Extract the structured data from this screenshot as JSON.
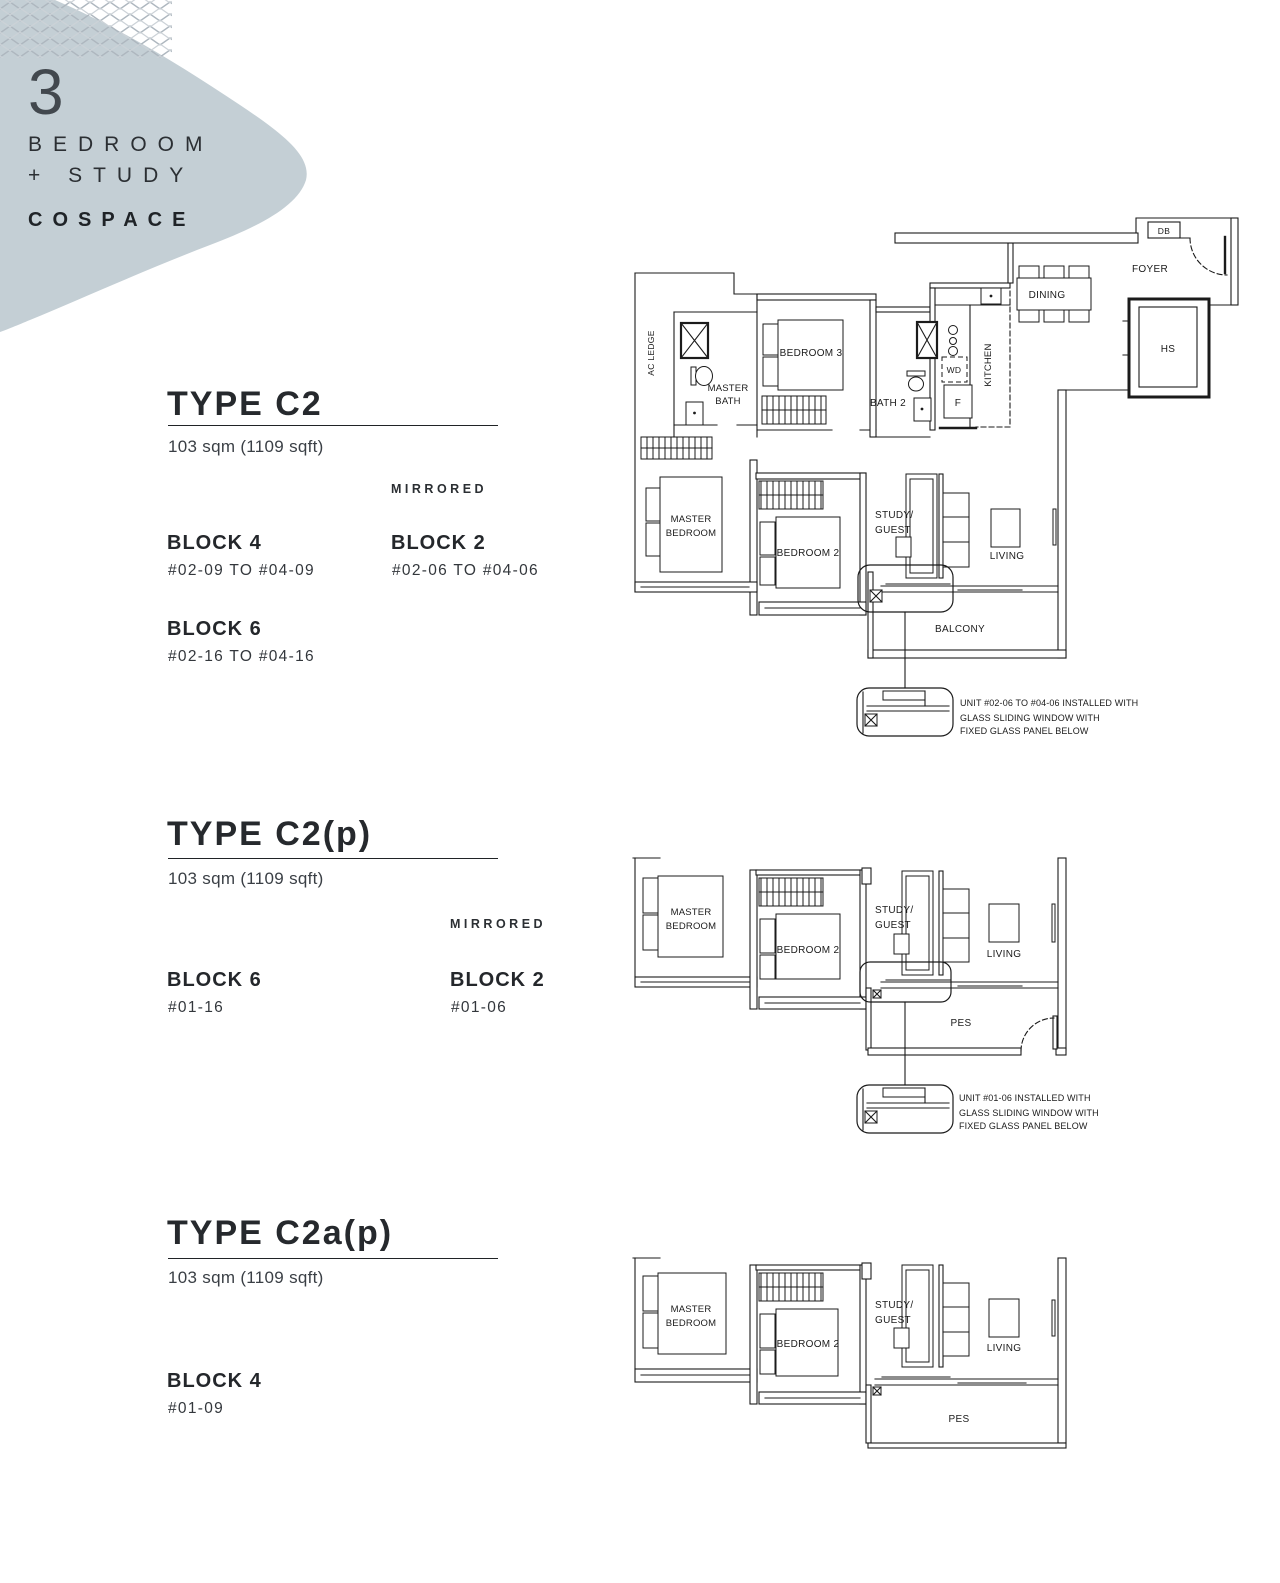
{
  "header": {
    "unit_number": "3",
    "unit_line1": "BEDROOM",
    "unit_line2": "+ STUDY",
    "brand": "COSPACE"
  },
  "sections": [
    {
      "title": "TYPE C2",
      "area": "103 sqm (1109 sqft)",
      "mirrored": "MIRRORED",
      "columns": {
        "col1": [
          {
            "block": "BLOCK 4",
            "units": "#02-09 TO #04-09"
          },
          {
            "block": "BLOCK 6",
            "units": "#02-16 TO #04-16"
          }
        ],
        "col2": [
          {
            "block": "BLOCK 2",
            "units": "#02-06 TO #04-06"
          }
        ]
      },
      "note": [
        "UNIT #02-06 TO #04-06 INSTALLED WITH",
        "GLASS SLIDING WINDOW WITH",
        "FIXED GLASS PANEL BELOW"
      ]
    },
    {
      "title": "TYPE C2(p)",
      "area": "103 sqm (1109 sqft)",
      "mirrored": "MIRRORED",
      "columns": {
        "col1": [
          {
            "block": "BLOCK 6",
            "units": "#01-16"
          }
        ],
        "col2": [
          {
            "block": "BLOCK 2",
            "units": "#01-06"
          }
        ]
      },
      "note": [
        "UNIT #01-06 INSTALLED WITH",
        "GLASS SLIDING WINDOW WITH",
        "FIXED GLASS PANEL BELOW"
      ]
    },
    {
      "title": "TYPE C2a(p)",
      "area": "103 sqm (1109 sqft)",
      "columns": {
        "col1": [
          {
            "block": "BLOCK 4",
            "units": "#01-09"
          }
        ]
      }
    }
  ],
  "plan_labels": {
    "c2": {
      "ac_ledge": "AC LEDGE",
      "master_bath1": "MASTER",
      "master_bath2": "BATH",
      "bedroom3": "BEDROOM 3",
      "bath2": "BATH 2",
      "wd": "WD",
      "fridge": "F",
      "kitchen": "KITCHEN",
      "dining": "DINING",
      "db": "DB",
      "foyer": "FOYER",
      "hs": "HS",
      "master_bed1": "MASTER",
      "master_bed2": "BEDROOM",
      "bedroom2": "BEDROOM 2",
      "study1": "STUDY/",
      "study2": "GUEST",
      "living": "LIVING",
      "balcony": "BALCONY"
    },
    "c2p": {
      "master_bed1": "MASTER",
      "master_bed2": "BEDROOM",
      "bedroom2": "BEDROOM 2",
      "study1": "STUDY/",
      "study2": "GUEST",
      "living": "LIVING",
      "pes": "PES"
    },
    "c2ap": {
      "master_bed1": "MASTER",
      "master_bed2": "BEDROOM",
      "bedroom2": "BEDROOM 2",
      "study1": "STUDY/",
      "study2": "GUEST",
      "living": "LIVING",
      "pes": "PES"
    }
  }
}
